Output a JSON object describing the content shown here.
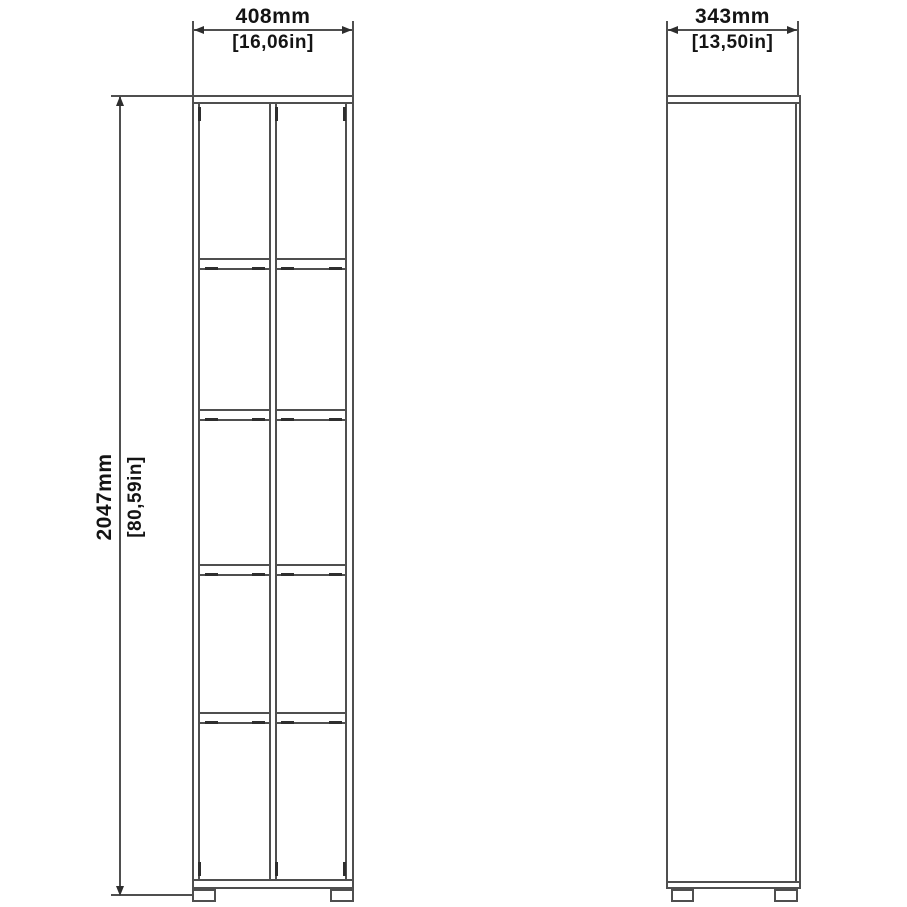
{
  "colors": {
    "line": "#4f4f4f",
    "dark": "#2e2e2e",
    "text": "#141414",
    "bg": "#ffffff"
  },
  "front_view": {
    "width": {
      "mm": "408mm",
      "in": "[16,06in]"
    },
    "height": {
      "mm": "2047mm",
      "in": "[80,59in]"
    }
  },
  "side_view": {
    "depth": {
      "mm": "343mm",
      "in": "[13,50in]"
    }
  }
}
